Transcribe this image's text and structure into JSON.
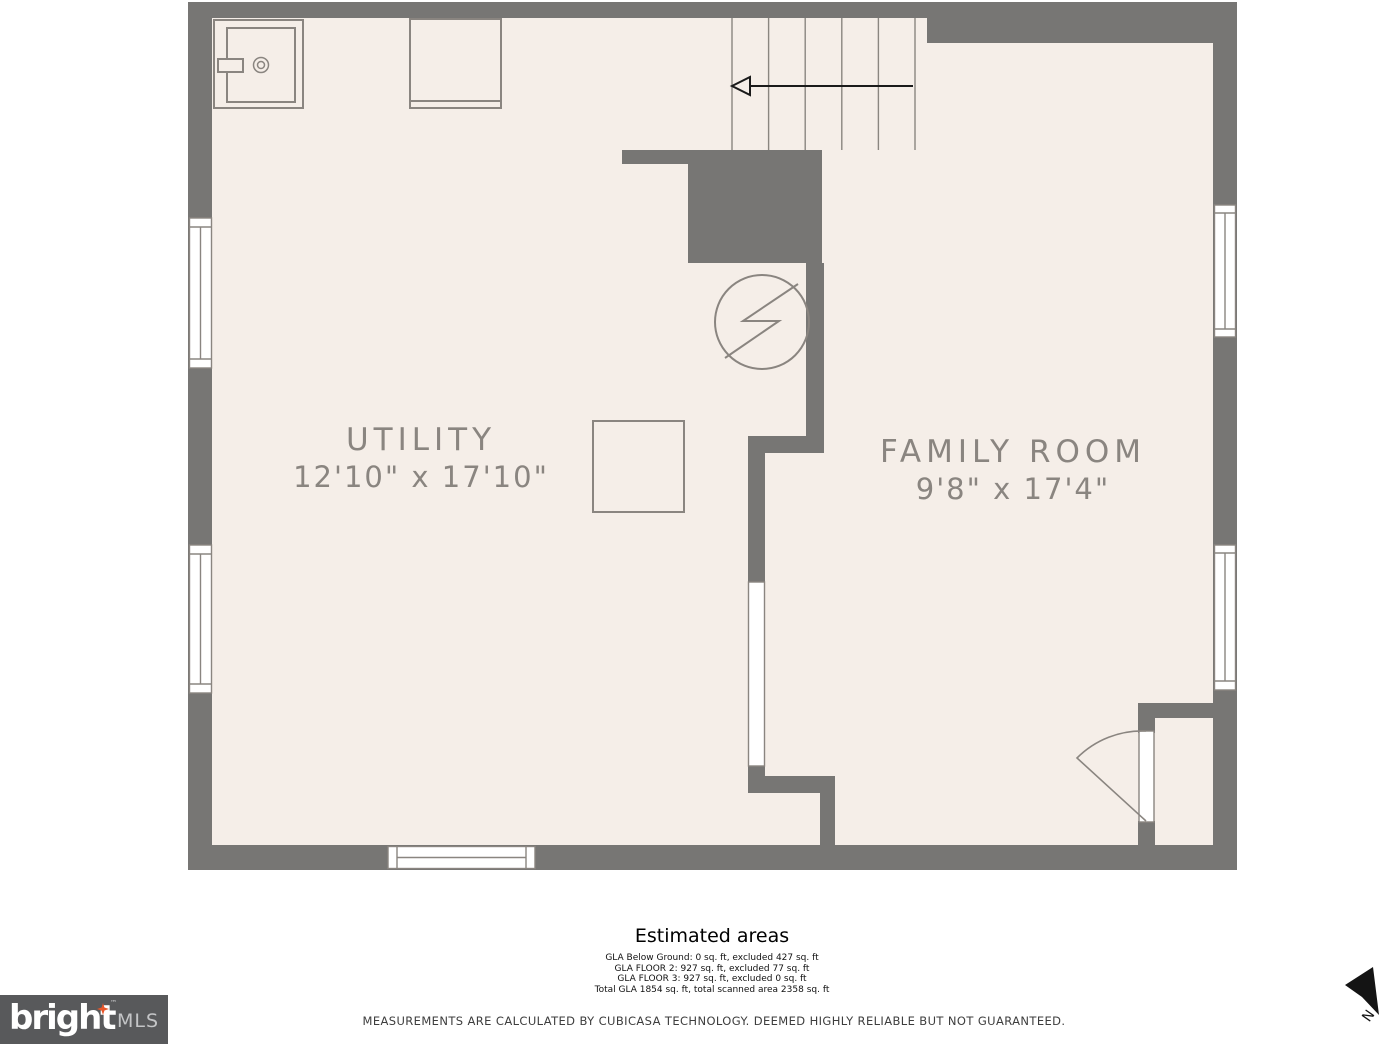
{
  "colors": {
    "wall": "#777674",
    "floor": "#f5eee8",
    "outline": "#8a8580",
    "label_text": "#8a8580",
    "arrow_black": "#1a1a1a",
    "logo_background": "#58595b",
    "logo_star_orange": "#e8562a",
    "page_background": "#ffffff"
  },
  "floor_plan": {
    "rooms": [
      {
        "name": "UTILITY",
        "dimensions": "12'10\" x 17'10\""
      },
      {
        "name": "FAMILY ROOM",
        "dimensions": "9'8\" x 17'4\""
      }
    ],
    "icons": {
      "water_heater": "water-heater-icon",
      "appliance": "appliance-counter-icon",
      "fixture_square": "fixture-square-icon",
      "electrical_panel": "electrical-panel-icon",
      "stairs_arrow": "stairs-direction-arrow-icon",
      "entry_door": "door-swing-icon",
      "window": "window-symbol-icon",
      "north_arrow": "north-arrow-icon"
    }
  },
  "estimated_areas": {
    "title": "Estimated areas",
    "lines": [
      "GLA Below Ground: 0 sq. ft, excluded 427 sq. ft",
      "GLA FLOOR 2: 927 sq. ft, excluded 77 sq. ft",
      "GLA FLOOR 3: 927 sq. ft, excluded 0 sq. ft",
      "Total GLA 1854 sq. ft, total scanned area 2358 sq. ft"
    ]
  },
  "disclaimer": "MEASUREMENTS ARE CALCULATED BY CUBICASA TECHNOLOGY. DEEMED HIGHLY RELIABLE BUT NOT GUARANTEED.",
  "logo": {
    "brand": "bright",
    "trademark": "™",
    "suffix": "MLS"
  },
  "compass": {
    "label": "N"
  }
}
